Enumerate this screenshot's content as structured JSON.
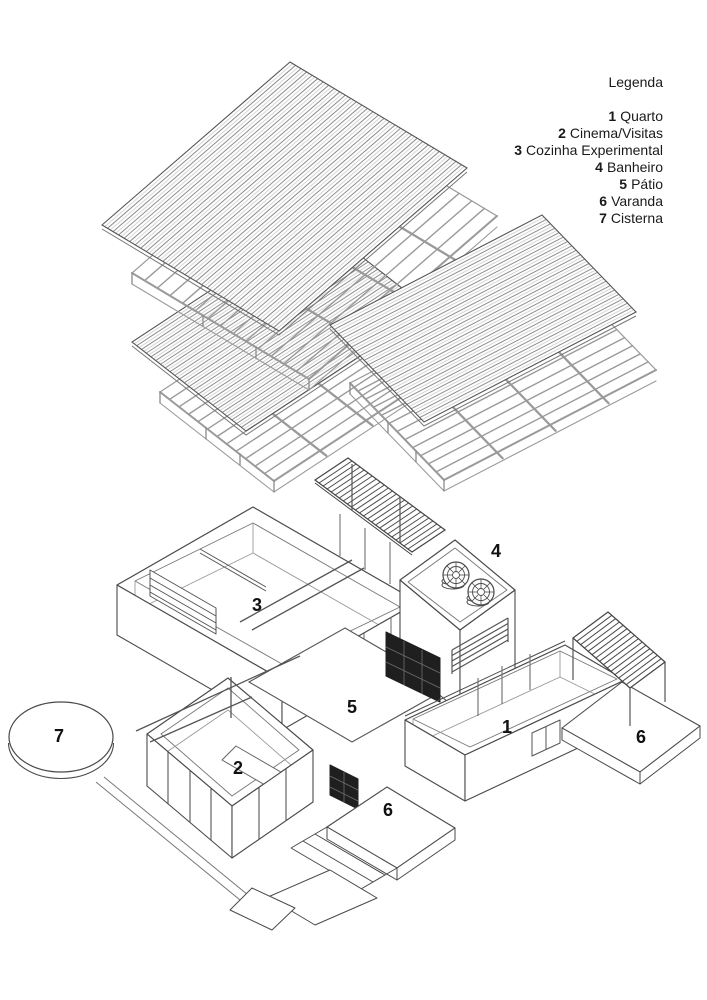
{
  "legend": {
    "title": "Legenda",
    "items": [
      {
        "num": "1",
        "label": "Quarto"
      },
      {
        "num": "2",
        "label": "Cinema/Visitas"
      },
      {
        "num": "3",
        "label": "Cozinha Experimental"
      },
      {
        "num": "4",
        "label": "Banheiro"
      },
      {
        "num": "5",
        "label": "Pátio"
      },
      {
        "num": "6",
        "label": "Varanda"
      },
      {
        "num": "7",
        "label": "Cisterna"
      }
    ]
  },
  "plan_labels": {
    "quarto": "1",
    "cinema": "2",
    "cozinha": "3",
    "banheiro": "4",
    "patio": "5",
    "varanda": "6",
    "cisterna": "7"
  },
  "drawing": {
    "type": "exploded-axonometric-house-diagram",
    "colors": {
      "background": "#ffffff",
      "line": "#4a4a4a",
      "light_line": "#8a8a8a",
      "stripe_dark": "#8f8f8f",
      "stripe_light": "#d6d6d6",
      "frame": "#9a9a9a",
      "screen_wall": "#1f1f1f",
      "text": "#111111"
    }
  }
}
